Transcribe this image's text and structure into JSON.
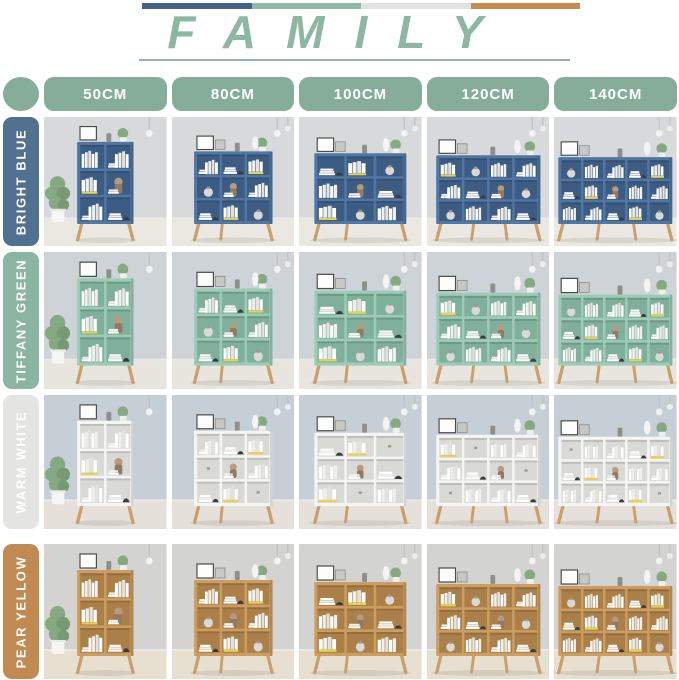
{
  "header": {
    "title": "FAMILY",
    "title_color": "#8eb7a2",
    "underline_color": "#8eb7a2",
    "bar_colors": [
      "#43618b",
      "#8fbaa5",
      "#e2e4e3",
      "#c98a50"
    ]
  },
  "legend_dot_color": "#85ad99",
  "size_pill_color": "#85ad99",
  "sizes": [
    {
      "label": "50CM",
      "compartment_cols": 2,
      "shelf_width_frac": 0.46,
      "shelf_top": 26
    },
    {
      "label": "80CM",
      "compartment_cols": 3,
      "shelf_width_frac": 0.64,
      "shelf_top": 36
    },
    {
      "label": "100CM",
      "compartment_cols": 3,
      "shelf_width_frac": 0.75,
      "shelf_top": 38
    },
    {
      "label": "120CM",
      "compartment_cols": 4,
      "shelf_width_frac": 0.85,
      "shelf_top": 40
    },
    {
      "label": "140CM",
      "compartment_cols": 5,
      "shelf_width_frac": 0.93,
      "shelf_top": 42
    }
  ],
  "rows": [
    {
      "label": "BRIGHT BLUE",
      "label_bg": "#527090",
      "shelf": "#5076a3",
      "shelf_inner": "#3d5c83",
      "wall": "#d7d9da",
      "floor": "#ebe8e2"
    },
    {
      "label": "TIFFANY GREEN",
      "label_bg": "#8ab5a0",
      "shelf": "#9ccbb7",
      "shelf_inner": "#7fb09b",
      "wall": "#cdd3d6",
      "floor": "#e8e5df"
    },
    {
      "label": "WARM WHITE",
      "label_bg": "#e4e4e2",
      "shelf": "#f5f5f3",
      "shelf_inner": "#d9d9d5",
      "wall": "#c6cfd6",
      "floor": "#e5e1da"
    },
    {
      "label": "PEAR YELLOW",
      "label_bg": "#c18a50",
      "shelf": "#cd9c5f",
      "shelf_inner": "#aa8048",
      "wall": "#d3d3d1",
      "floor": "#e7dfd0"
    }
  ],
  "scene_palette": {
    "leg_wood": "#c9a06b",
    "book_white": "#ffffff",
    "book_light": "#efefec",
    "book_shadow": "#e2e2de",
    "accent_yellow": "#e6d24e",
    "hat_dark": "#3a3d40",
    "doll_tan": "#b79b80",
    "doll_body": "#8f7a66",
    "plant_green": "#85a981",
    "vase_gray": "#d9d9d6"
  }
}
